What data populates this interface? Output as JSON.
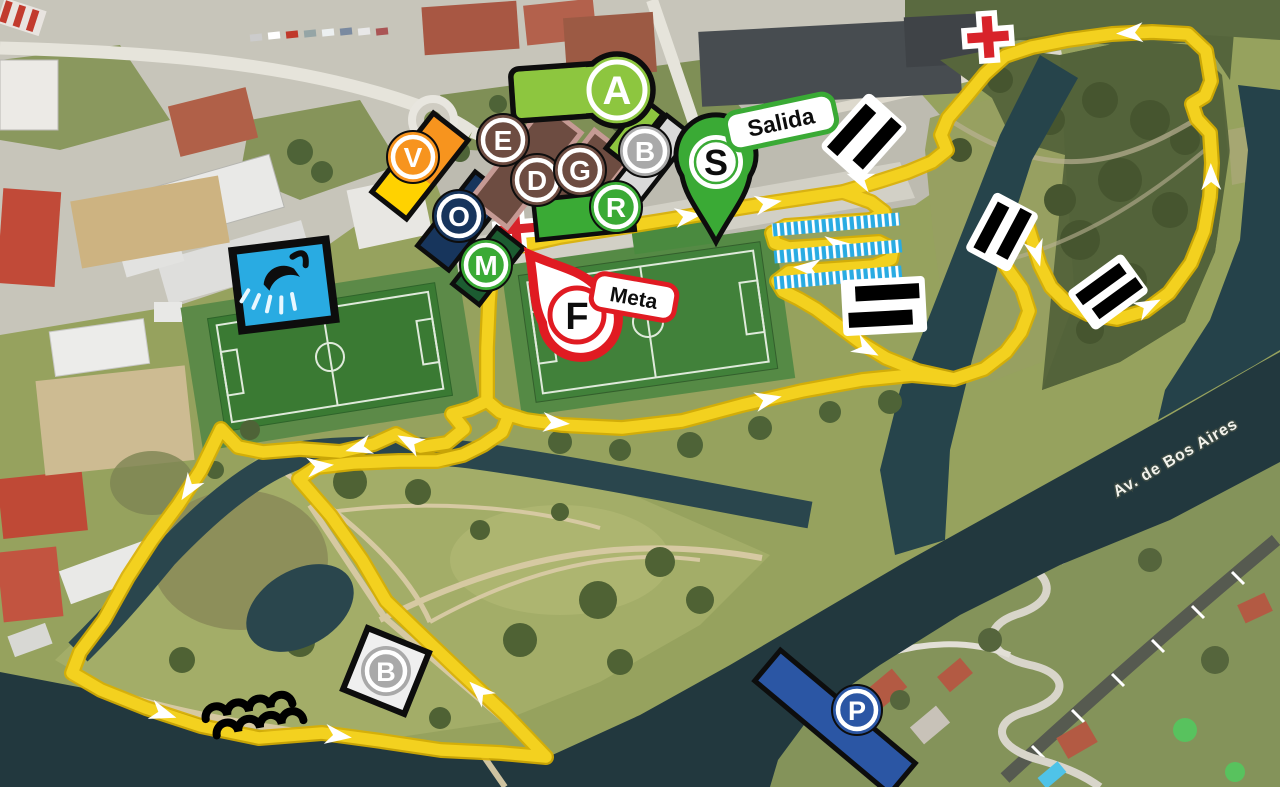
{
  "map": {
    "street_label": "Av. de Bos Aires",
    "type": "cyclocross-race-course-map-over-satellite-photo"
  },
  "markers": {
    "a": "A",
    "b_top": "B",
    "e": "E",
    "d": "D",
    "g": "G",
    "r": "R",
    "v": "V",
    "o": "O",
    "m": "M",
    "b_bottom": "B",
    "p": "P",
    "start_letter": "S",
    "start_label": "Salida",
    "finish_letter": "F",
    "finish_label": "Meta"
  },
  "icons": [
    "first-aid-cross-icon",
    "shower-icon",
    "stairs-obstacle-icon",
    "planks-obstacle-icon",
    "sand-waves-icon",
    "parking-icon",
    "start-pin-icon",
    "finish-pin-icon",
    "direction-arrow-icon"
  ],
  "colors": {
    "course": "#f3d11f",
    "course_edge": "#d9af00",
    "water": "#22383e",
    "lime": "#8dc63f",
    "green": "#3aaa35",
    "brown": "#6d4c41",
    "brown_border": "#c59a94",
    "gray_circle": "#a9a9a9",
    "gray_bar": "#d9d9d9",
    "navy": "#17355c",
    "dark_green_bar": "#1c5c31",
    "orange": "#f7941e",
    "yellow": "#ffd200",
    "red": "#e01b22",
    "planks_blue": "#29abe2",
    "parking_blue": "#2b56a4"
  }
}
